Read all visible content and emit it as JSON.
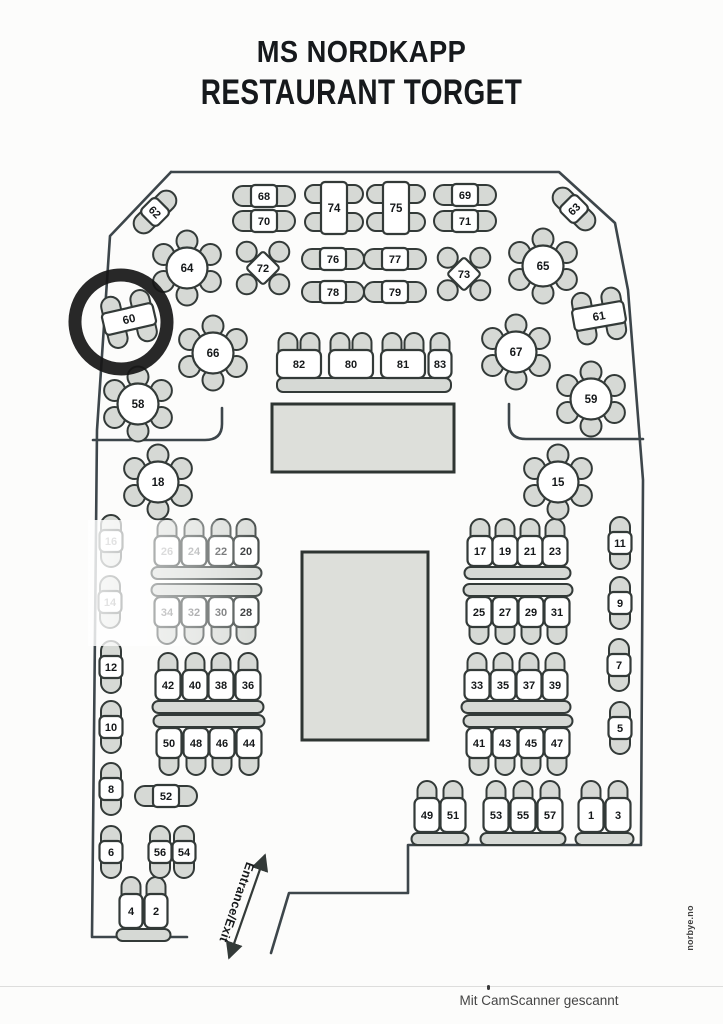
{
  "title": {
    "line1": "MS NORDKAPP",
    "line2": "RESTAURANT TORGET"
  },
  "entrance_label": "Entrance/Exit",
  "side_credit": "norbye.no",
  "scanner_watermark": "Mit CamScanner gescannt",
  "highlight": {
    "table": "60"
  },
  "colors": {
    "wall": "#3d464b",
    "line": "#333a38",
    "chair_fill": "#d6d9d5",
    "table_fill": "#ffffff",
    "buffet_fill": "#dddfda",
    "text": "#15181a",
    "marker_ring": "#161616"
  },
  "floorplan": {
    "tables": [
      {
        "n": "62",
        "t": "duo2v",
        "x": 155,
        "y": 212,
        "rot": 45
      },
      {
        "n": "68",
        "t": "duo2h",
        "x": 264,
        "y": 196
      },
      {
        "n": "70",
        "t": "duo2h",
        "x": 264,
        "y": 221
      },
      {
        "n": "74",
        "t": "quad4v",
        "x": 334,
        "y": 208
      },
      {
        "n": "75",
        "t": "quad4v",
        "x": 396,
        "y": 208
      },
      {
        "n": "69",
        "t": "duo2h",
        "x": 465,
        "y": 195
      },
      {
        "n": "71",
        "t": "duo2h",
        "x": 465,
        "y": 221
      },
      {
        "n": "63",
        "t": "duo2v",
        "x": 574,
        "y": 209,
        "rot": -45
      },
      {
        "n": "64",
        "t": "round6",
        "x": 187,
        "y": 268
      },
      {
        "n": "72",
        "t": "diamond4",
        "x": 263,
        "y": 268
      },
      {
        "n": "76",
        "t": "duo2h",
        "x": 333,
        "y": 259
      },
      {
        "n": "77",
        "t": "duo2h",
        "x": 395,
        "y": 259
      },
      {
        "n": "78",
        "t": "duo2h",
        "x": 333,
        "y": 292
      },
      {
        "n": "79",
        "t": "duo2h",
        "x": 395,
        "y": 292
      },
      {
        "n": "73",
        "t": "diamond4",
        "x": 464,
        "y": 274
      },
      {
        "n": "65",
        "t": "round6",
        "x": 543,
        "y": 266
      },
      {
        "n": "60",
        "t": "quad4h",
        "x": 129,
        "y": 319,
        "rot": -13
      },
      {
        "n": "61",
        "t": "quad4h",
        "x": 599,
        "y": 316,
        "rot": -10
      },
      {
        "n": "66",
        "t": "round6",
        "x": 213,
        "y": 353
      },
      {
        "n": "67",
        "t": "round6",
        "x": 516,
        "y": 352
      },
      {
        "n": "58",
        "t": "round6",
        "x": 138,
        "y": 404
      },
      {
        "n": "59",
        "t": "round6",
        "x": 591,
        "y": 399
      },
      {
        "n": "18",
        "t": "round6",
        "x": 158,
        "y": 482
      },
      {
        "n": "15",
        "t": "round6",
        "x": 558,
        "y": 482
      },
      {
        "n": "16",
        "t": "duo2v",
        "x": 111,
        "y": 541,
        "faded": 0.5
      },
      {
        "n": "14",
        "t": "duo2v",
        "x": 110,
        "y": 602,
        "faded": 0.55
      },
      {
        "n": "12",
        "t": "duo2v",
        "x": 111,
        "y": 667
      },
      {
        "n": "10",
        "t": "duo2v",
        "x": 111,
        "y": 727
      },
      {
        "n": "8",
        "t": "duo2v",
        "x": 111,
        "y": 789
      },
      {
        "n": "6",
        "t": "duo2v",
        "x": 111,
        "y": 852
      },
      {
        "n": "56",
        "t": "duo2v",
        "x": 160,
        "y": 852
      },
      {
        "n": "54",
        "t": "duo2v",
        "x": 184,
        "y": 852
      },
      {
        "n": "52",
        "t": "duo2h",
        "x": 166,
        "y": 796
      },
      {
        "n": "11",
        "t": "duo2v",
        "x": 620,
        "y": 543
      },
      {
        "n": "9",
        "t": "duo2v",
        "x": 620,
        "y": 603
      },
      {
        "n": "7",
        "t": "duo2v",
        "x": 619,
        "y": 665
      },
      {
        "n": "5",
        "t": "duo2v",
        "x": 620,
        "y": 728
      }
    ],
    "booths": [
      {
        "labels": [
          "82",
          "80",
          "81",
          "83"
        ],
        "y": 364,
        "centers": [
          299,
          351,
          403,
          440
        ],
        "tw": [
          44,
          44,
          44,
          23
        ],
        "th": 28,
        "chairs": "top",
        "chairs_per": [
          2,
          2,
          2,
          1
        ],
        "bench": [
          277,
          378,
          174,
          14
        ]
      },
      {
        "labels": [
          "26",
          "24",
          "22",
          "20"
        ],
        "y": 551,
        "centers": [
          167,
          194,
          221,
          246
        ],
        "chairs": "top",
        "faded": [
          0.35,
          0.45,
          0.8,
          1
        ]
      },
      {
        "labels": [
          "34",
          "32",
          "30",
          "28"
        ],
        "y": 612,
        "centers": [
          167,
          194,
          221,
          246
        ],
        "chairs": "bottom",
        "faded": [
          0.55,
          0.6,
          0.75,
          1
        ]
      },
      {
        "labels": [
          "42",
          "40",
          "38",
          "36"
        ],
        "y": 685,
        "centers": [
          168,
          195,
          221,
          248
        ],
        "chairs": "top"
      },
      {
        "labels": [
          "50",
          "48",
          "46",
          "44"
        ],
        "y": 743,
        "centers": [
          169,
          196,
          222,
          249
        ],
        "chairs": "bottom"
      },
      {
        "labels": [
          "17",
          "19",
          "21",
          "23"
        ],
        "y": 551,
        "centers": [
          480,
          505,
          530,
          555
        ],
        "chairs": "top"
      },
      {
        "labels": [
          "25",
          "27",
          "29",
          "31"
        ],
        "y": 612,
        "centers": [
          479,
          505,
          531,
          557
        ],
        "chairs": "bottom"
      },
      {
        "labels": [
          "33",
          "35",
          "37",
          "39"
        ],
        "y": 685,
        "centers": [
          477,
          503,
          529,
          555
        ],
        "chairs": "top"
      },
      {
        "labels": [
          "41",
          "43",
          "45",
          "47"
        ],
        "y": 743,
        "centers": [
          479,
          505,
          531,
          557
        ],
        "chairs": "bottom"
      },
      {
        "labels": [
          "49",
          "51"
        ],
        "y": 815,
        "centers": [
          427,
          453
        ],
        "th": 34,
        "chairs": "top"
      },
      {
        "labels": [
          "53",
          "55",
          "57"
        ],
        "y": 815,
        "centers": [
          496,
          523,
          550
        ],
        "th": 34,
        "chairs": "top"
      },
      {
        "labels": [
          "1",
          "3"
        ],
        "y": 815,
        "centers": [
          591,
          618
        ],
        "th": 34,
        "chairs": "top"
      },
      {
        "labels": [
          "4",
          "2"
        ],
        "y": 911,
        "centers": [
          131,
          156
        ],
        "th": 34,
        "tw": 23,
        "chairs": "top"
      }
    ],
    "service_areas": [
      {
        "x": 272,
        "y": 404,
        "w": 182,
        "h": 68
      },
      {
        "x": 302,
        "y": 552,
        "w": 126,
        "h": 188
      }
    ],
    "highlight_ring": {
      "cx": 121,
      "cy": 322,
      "rx": 46,
      "ry": 47,
      "width": 13
    }
  }
}
